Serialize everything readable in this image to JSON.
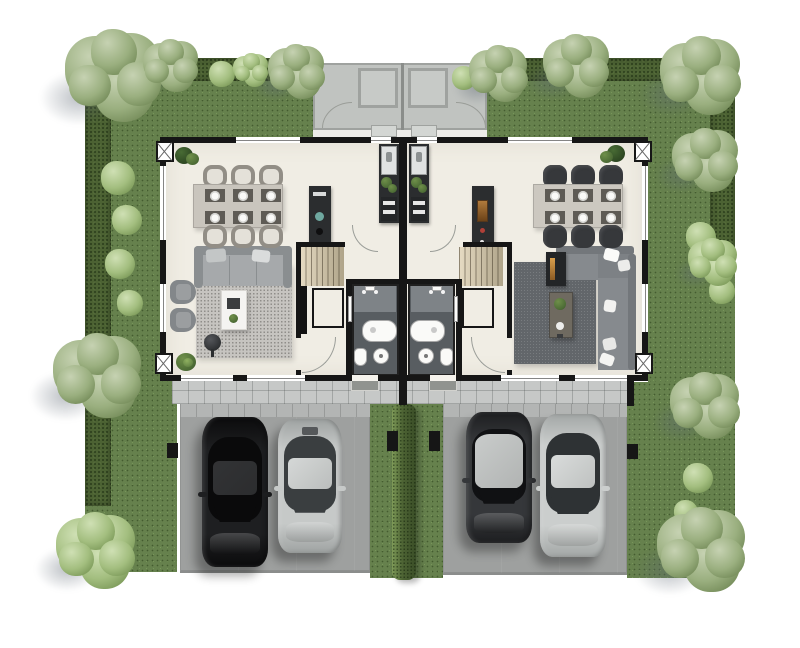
{
  "scene": {
    "type": "architectural-floor-plan",
    "description": "Top-down 3D rendered ground-floor plan of a mirrored duplex (twin home) with wrap-around garden, hedged borders, rear terrace, central shared stair/bath core, and two front driveways with two parked cars each",
    "units": [
      "left-unit",
      "right-unit"
    ]
  },
  "rooms": {
    "left_unit": [
      "dining-area",
      "kitchen",
      "living-room",
      "bathroom",
      "staircase",
      "entry-hall"
    ],
    "right_unit": [
      "dining-area",
      "kitchen",
      "living-room",
      "bathroom",
      "staircase",
      "entry-hall"
    ],
    "shared": [
      "rear-terrace",
      "front-path",
      "left-driveway",
      "right-driveway",
      "garden",
      "center-hedge"
    ]
  },
  "palette": {
    "background": "#FFFFFF",
    "lawn": "#66814D",
    "hedge": "#4C6233",
    "hedge_light": "#7E9A58",
    "hedge_dark": "#3A4E27",
    "wall": "#161616",
    "floor": "#F0EDE4",
    "terrace": "#C0C3C0",
    "terrace_line": "#9FA29F",
    "path": "#C6C8C7",
    "drive": "#9EA09F",
    "drive_band": "#B3B5B4",
    "bath_floor": "#585D61",
    "shower": "#7E8387",
    "stair": "#CBBFA6",
    "rug_left": "#C6C4C0",
    "rug_right": "#62666A",
    "sofa_left": "#A6A9AB",
    "sofa_left_dark": "#8A8E90",
    "sofa_right": "#868A8E",
    "sofa_right_dark": "#73777B",
    "counter": "#2B2D2F",
    "plant": "#4C6B35",
    "plant_light": "#6F8F4A",
    "amber": "#96612F",
    "teal": "#6FA8A0"
  },
  "garden": {
    "shadow_color": "rgba(95,105,116,0.42)",
    "palettes": {
      "sage": [
        "#C6D2B2",
        "#9AAF7F",
        "#647C49"
      ],
      "bright": [
        "#CFE0B4",
        "#A3BE7F",
        "#6B8A49"
      ]
    },
    "trees": [
      {
        "x": 116,
        "y": 76,
        "r": 52,
        "p": "sage"
      },
      {
        "x": 172,
        "y": 66,
        "r": 30,
        "p": "sage"
      },
      {
        "x": 252,
        "y": 70,
        "r": 19,
        "p": "bright"
      },
      {
        "x": 298,
        "y": 72,
        "r": 31,
        "p": "sage"
      },
      {
        "x": 500,
        "y": 74,
        "r": 32,
        "p": "sage"
      },
      {
        "x": 578,
        "y": 66,
        "r": 36,
        "p": "sage"
      },
      {
        "x": 703,
        "y": 76,
        "r": 44,
        "p": "sage"
      },
      {
        "x": 707,
        "y": 160,
        "r": 36,
        "p": "sage"
      },
      {
        "x": 714,
        "y": 262,
        "r": 27,
        "p": "bright"
      },
      {
        "x": 707,
        "y": 406,
        "r": 38,
        "p": "sage"
      },
      {
        "x": 704,
        "y": 550,
        "r": 48,
        "p": "sage"
      },
      {
        "x": 100,
        "y": 376,
        "r": 48,
        "p": "sage"
      },
      {
        "x": 98,
        "y": 551,
        "r": 43,
        "p": "bright"
      }
    ],
    "bushes": [
      {
        "x": 118,
        "y": 178,
        "r": 17
      },
      {
        "x": 127,
        "y": 220,
        "r": 15
      },
      {
        "x": 120,
        "y": 264,
        "r": 15
      },
      {
        "x": 130,
        "y": 303,
        "r": 13
      },
      {
        "x": 701,
        "y": 237,
        "r": 15
      },
      {
        "x": 722,
        "y": 291,
        "r": 13
      },
      {
        "x": 698,
        "y": 478,
        "r": 15
      },
      {
        "x": 686,
        "y": 512,
        "r": 12
      },
      {
        "x": 222,
        "y": 74,
        "r": 13
      },
      {
        "x": 464,
        "y": 78,
        "r": 12
      }
    ]
  },
  "cars": [
    {
      "name": "car-black-sedan",
      "x": 202,
      "y": 417,
      "w": 66,
      "h": 150,
      "body": "#1E1F21",
      "shade": "#0B0B0C",
      "roof": "#323335",
      "glass": "#0A0A0B",
      "bigroof": false,
      "sunroof": false
    },
    {
      "name": "car-silver-sedan",
      "x": 278,
      "y": 419,
      "w": 64,
      "h": 134,
      "body": "#C6C9C8",
      "shade": "#9FA3A2",
      "roof": "#D5D8D7",
      "glass": "#3A3E40",
      "bigroof": false,
      "sunroof": true
    },
    {
      "name": "car-graphite-hatch",
      "x": 466,
      "y": 412,
      "w": 66,
      "h": 131,
      "body": "#35373A",
      "shade": "#1D1E20",
      "roof": "#C9CCCB",
      "glass": "#101113",
      "bigroof": true,
      "sunroof": false
    },
    {
      "name": "car-silver-sedan-2",
      "x": 540,
      "y": 414,
      "w": 66,
      "h": 143,
      "body": "#CBCECD",
      "shade": "#A3A7A6",
      "roof": "#D9DCDB",
      "glass": "#2E3234",
      "bigroof": false,
      "sunroof": false
    }
  ],
  "dining": {
    "left": {
      "style": "ring",
      "chair_color": "#928E86",
      "chair_inner": "#E4E1D9",
      "cols": [
        203,
        231,
        259
      ],
      "top_y": 165,
      "bottom_y": 225,
      "chair_w": 24,
      "chair_h": 23,
      "table": {
        "x": 193,
        "y": 184,
        "w": 90,
        "h": 44,
        "color": "#C9C5BD"
      },
      "mat_rows": [
        189,
        211
      ],
      "mat_color": "#5E5B55",
      "plate_color": "#FAFAF8",
      "seats": 6
    },
    "right": {
      "style": "solid",
      "chair_color": "#36383B",
      "chair_inner": "#4A4C4F",
      "cols": [
        543,
        571,
        599
      ],
      "top_y": 165,
      "bottom_y": 225,
      "chair_w": 24,
      "chair_h": 23,
      "table": {
        "x": 533,
        "y": 184,
        "w": 90,
        "h": 44,
        "color": "#CCC8C0"
      },
      "mat_rows": [
        189,
        211
      ],
      "mat_color": "#5E5B55",
      "plate_color": "#FAFAF8",
      "seats": 6
    }
  },
  "column_markers": [
    [
      156,
      141
    ],
    [
      155,
      353
    ],
    [
      634,
      141
    ],
    [
      635,
      353
    ]
  ],
  "gate_posts": [
    [
      167,
      443,
      11,
      15
    ],
    [
      387,
      431,
      11,
      20
    ],
    [
      429,
      431,
      11,
      20
    ],
    [
      627,
      444,
      11,
      15
    ]
  ]
}
